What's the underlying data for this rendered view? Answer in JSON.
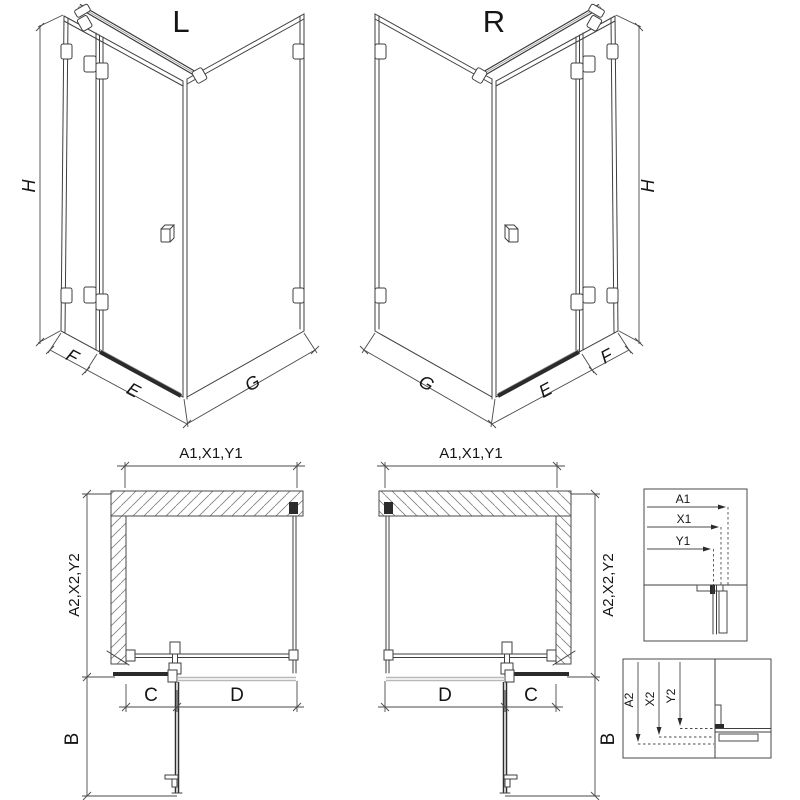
{
  "iso": {
    "left_title": "L",
    "right_title": "R",
    "h": "H",
    "f": "F",
    "e": "E",
    "g": "G"
  },
  "plan": {
    "width_dim": "A1,X1,Y1",
    "depth_dim": "A2,X2,Y2",
    "c": "C",
    "d": "D",
    "b": "B"
  },
  "detail1": {
    "a": "A1",
    "x": "X1",
    "y": "Y1"
  },
  "detail2": {
    "a": "A2",
    "x": "X2",
    "y": "Y2"
  },
  "colors": {
    "line": "#3f3f3f",
    "dimension": "#4a4a4a",
    "dark_profile": "#2b2b2b",
    "tray_edge": "#b8b8b8",
    "background": "#ffffff"
  }
}
